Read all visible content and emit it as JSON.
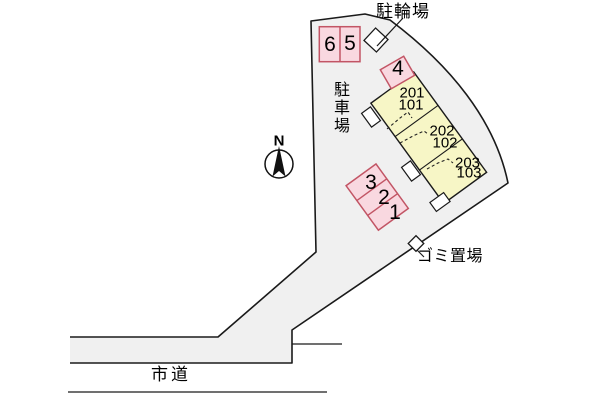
{
  "site_plan": {
    "title_hint": "apartment site plan",
    "compass": {
      "north_label": "N"
    },
    "labels": {
      "bicycle_parking": "駐輪場",
      "car_parking": "駐車場",
      "garbage_area": "ゴミ置場",
      "city_road": "市道"
    },
    "parking_spaces": [
      "6",
      "5",
      "4",
      "3",
      "2",
      "1"
    ],
    "building": {
      "units": [
        {
          "upper": "201",
          "lower": "101"
        },
        {
          "upper": "202",
          "lower": "102"
        },
        {
          "upper": "203",
          "lower": "103"
        }
      ]
    },
    "colors": {
      "site_fill": "#f0f0f0",
      "outline": "#1a1a1a",
      "building_fill": "#f7f6c6",
      "parking_fill": "#f9d8e0",
      "parking_stroke": "#c25565"
    }
  }
}
